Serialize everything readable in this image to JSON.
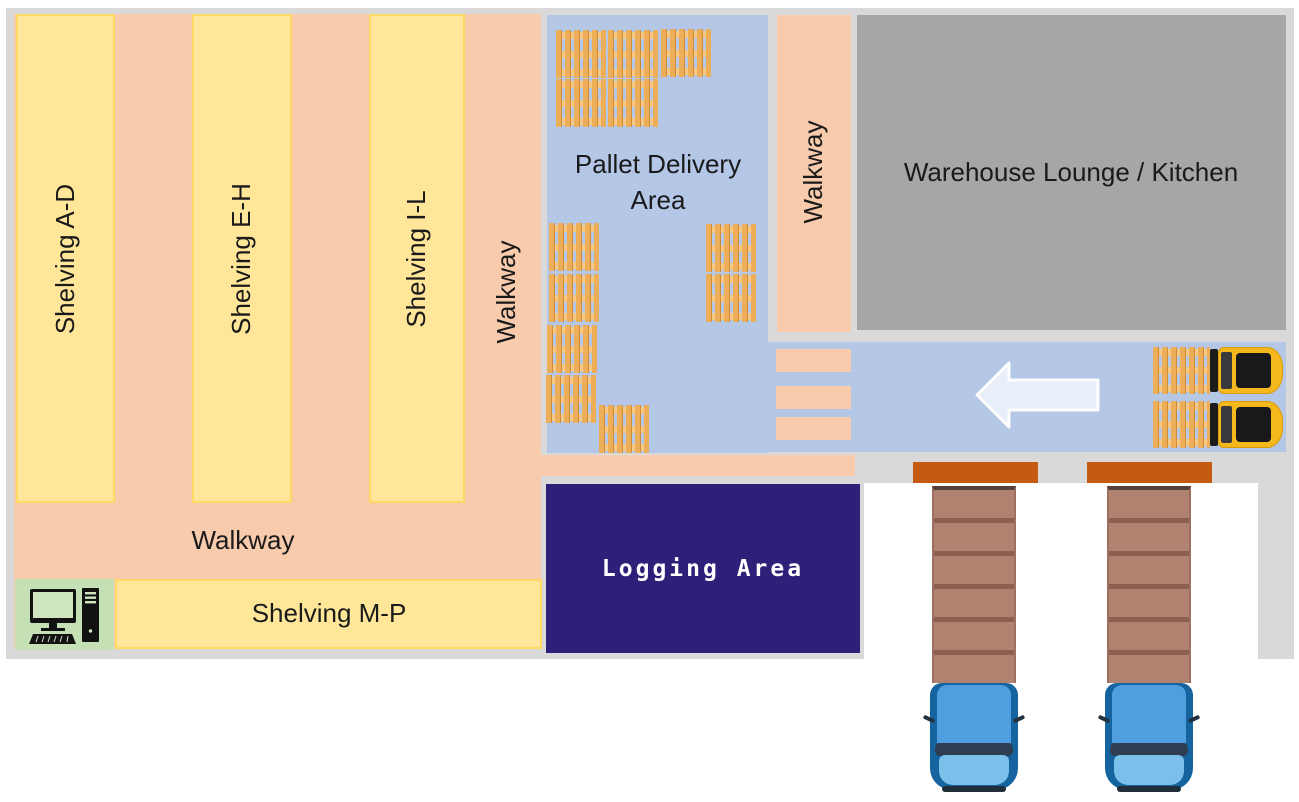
{
  "diagram_title": "Warehouse floor plan",
  "colors": {
    "panel_bg": "#d9d9d9",
    "walkway_peach": "#f8cbad",
    "shelving_yellow": "#ffe699",
    "shelving_border": "#ffd966",
    "floor_blue": "#b4c7e7",
    "lounge_gray": "#a6a6a6",
    "logging_navy": "#2e2078",
    "dock_orange": "#c55a11",
    "station_green": "#c5e0b4",
    "arrow_fill": "#e9eff9"
  },
  "labels": {
    "shelving_ad": "Shelving A-D",
    "shelving_eh": "Shelving E-H",
    "shelving_il": "Shelving I-L",
    "walkway_left": "Walkway",
    "walkway_right": "Walkway",
    "walkway_main": "Walkway",
    "pallet_delivery_line1": "Pallet Delivery",
    "pallet_delivery_line2": "Area",
    "lounge": "Warehouse Lounge / Kitchen",
    "shelving_mp": "Shelving M-P",
    "logging": "Logging Area"
  },
  "icons": {
    "delivery_pallets": [
      {
        "x": 556,
        "y": 30
      },
      {
        "x": 608,
        "y": 30
      },
      {
        "x": 661,
        "y": 29
      },
      {
        "x": 556,
        "y": 79
      },
      {
        "x": 608,
        "y": 79
      },
      {
        "x": 549,
        "y": 223
      },
      {
        "x": 549,
        "y": 274
      },
      {
        "x": 547,
        "y": 325
      },
      {
        "x": 546,
        "y": 375
      },
      {
        "x": 599,
        "y": 405
      },
      {
        "x": 706,
        "y": 224
      },
      {
        "x": 706,
        "y": 274
      }
    ],
    "forklifts": [
      {
        "x": 1153,
        "y": 347
      },
      {
        "x": 1153,
        "y": 401
      }
    ],
    "crosswalk_bars": [
      {
        "y": 349
      },
      {
        "y": 386
      },
      {
        "y": 417
      }
    ],
    "docks": [
      {
        "x": 913
      },
      {
        "x": 1087
      }
    ],
    "trucks": [
      {
        "x": 930
      },
      {
        "x": 1105
      }
    ]
  }
}
